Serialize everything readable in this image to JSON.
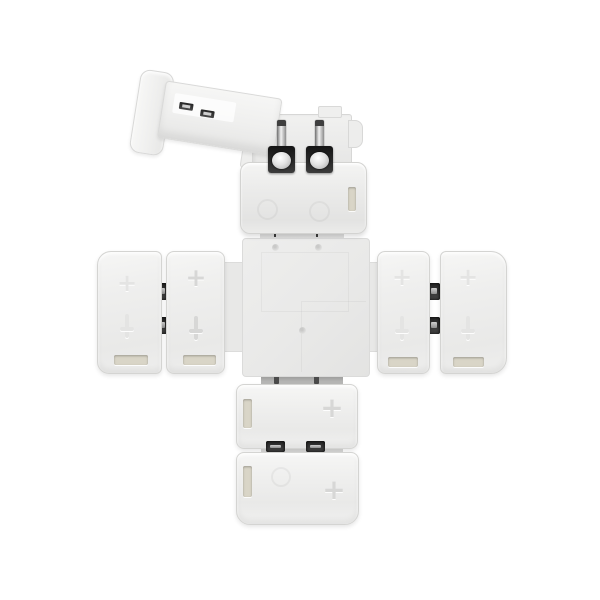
{
  "meta": {
    "type": "product-photo",
    "subject": "White plastic X-shaped 4-way LED strip clip connector on a white background; the top clip's hinged cover is flipped open revealing two metal contact pins; each arm holds snap-on clip terminals with embossed polarity marks"
  },
  "palette": {
    "bg": "#ffffff",
    "plastic_light": "#f6f6f5",
    "plastic_mid": "#e9e9e8",
    "plastic_edge": "#d4d4d2",
    "cross_plate": "#e9e9e8",
    "tab_gray": "#b4b4b3",
    "metal_dark": "#2e2e2e",
    "metal_silver": "#a8a8a8",
    "slot_recess": "#d9d5c7",
    "emboss": "#d7d7d6",
    "emboss_faint": "#e4e4e3"
  },
  "marks": {
    "plus": "+",
    "minus": "−"
  },
  "labels": {
    "figure_alt": "Cross-shaped LED strip connector with four white clip terminals, top cover open showing two metal pins"
  }
}
